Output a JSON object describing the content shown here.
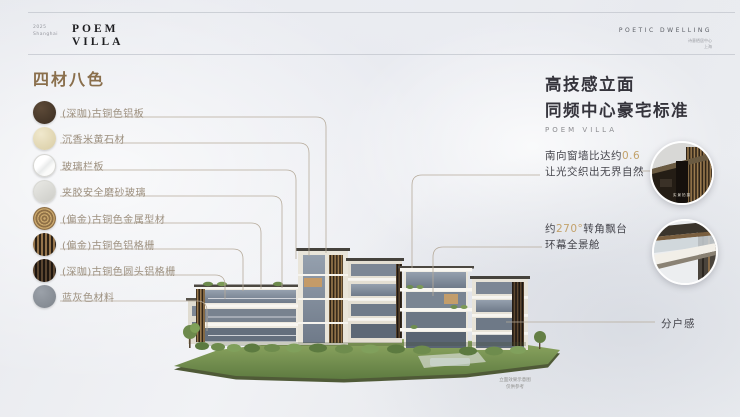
{
  "header": {
    "year": "2025",
    "city": "Shanghai",
    "logo_line1": "POEM",
    "logo_line2": "VILLA",
    "right_title": "POETIC DWELLING",
    "fineprint_line1": "诗意栖居中心",
    "fineprint_line2": "上海"
  },
  "materials": {
    "title": "四材八色",
    "items": [
      {
        "label": "(深咖)古铜色铝板",
        "swatch": "dark-brown"
      },
      {
        "label": "沉香米黄石材",
        "swatch": "cream"
      },
      {
        "label": "玻璃栏板",
        "swatch": "glass"
      },
      {
        "label": "夹胶安全磨砂玻璃",
        "swatch": "frosted"
      },
      {
        "label": "(偏金)古铜色金属型材",
        "swatch": "brushed-gold"
      },
      {
        "label": "(偏金)古铜色铝格栅",
        "swatch": "gold-louver"
      },
      {
        "label": "(深咖)古铜色圆头铝格栅",
        "swatch": "dark-louver"
      },
      {
        "label": "蓝灰色材料",
        "swatch": "blue-gray"
      }
    ]
  },
  "right_panel": {
    "title_line1": "高技感立面",
    "title_line2": "同频中心豪宅标准",
    "subtitle": "POEM VILLA",
    "annotation1": {
      "prefix": "南向窗墙比达约",
      "highlight": "0.6",
      "line2": "让光交织出无界自然"
    },
    "annotation2": {
      "prefix": "约",
      "highlight": "270°",
      "suffix": "转角飘台",
      "line2": "环幕全景舱"
    },
    "annotation3": {
      "label": "分户感"
    },
    "callout1_caption": "实景拍摄"
  },
  "building": {
    "caption_line1": "立面效果示意图",
    "caption_line2": "仅供参考"
  },
  "colors": {
    "accent_gold": "#C3A26B",
    "materials_title_brown": "#8A6F4C",
    "leader_line": "#B6AB9B",
    "heading_dark": "#35343C"
  }
}
